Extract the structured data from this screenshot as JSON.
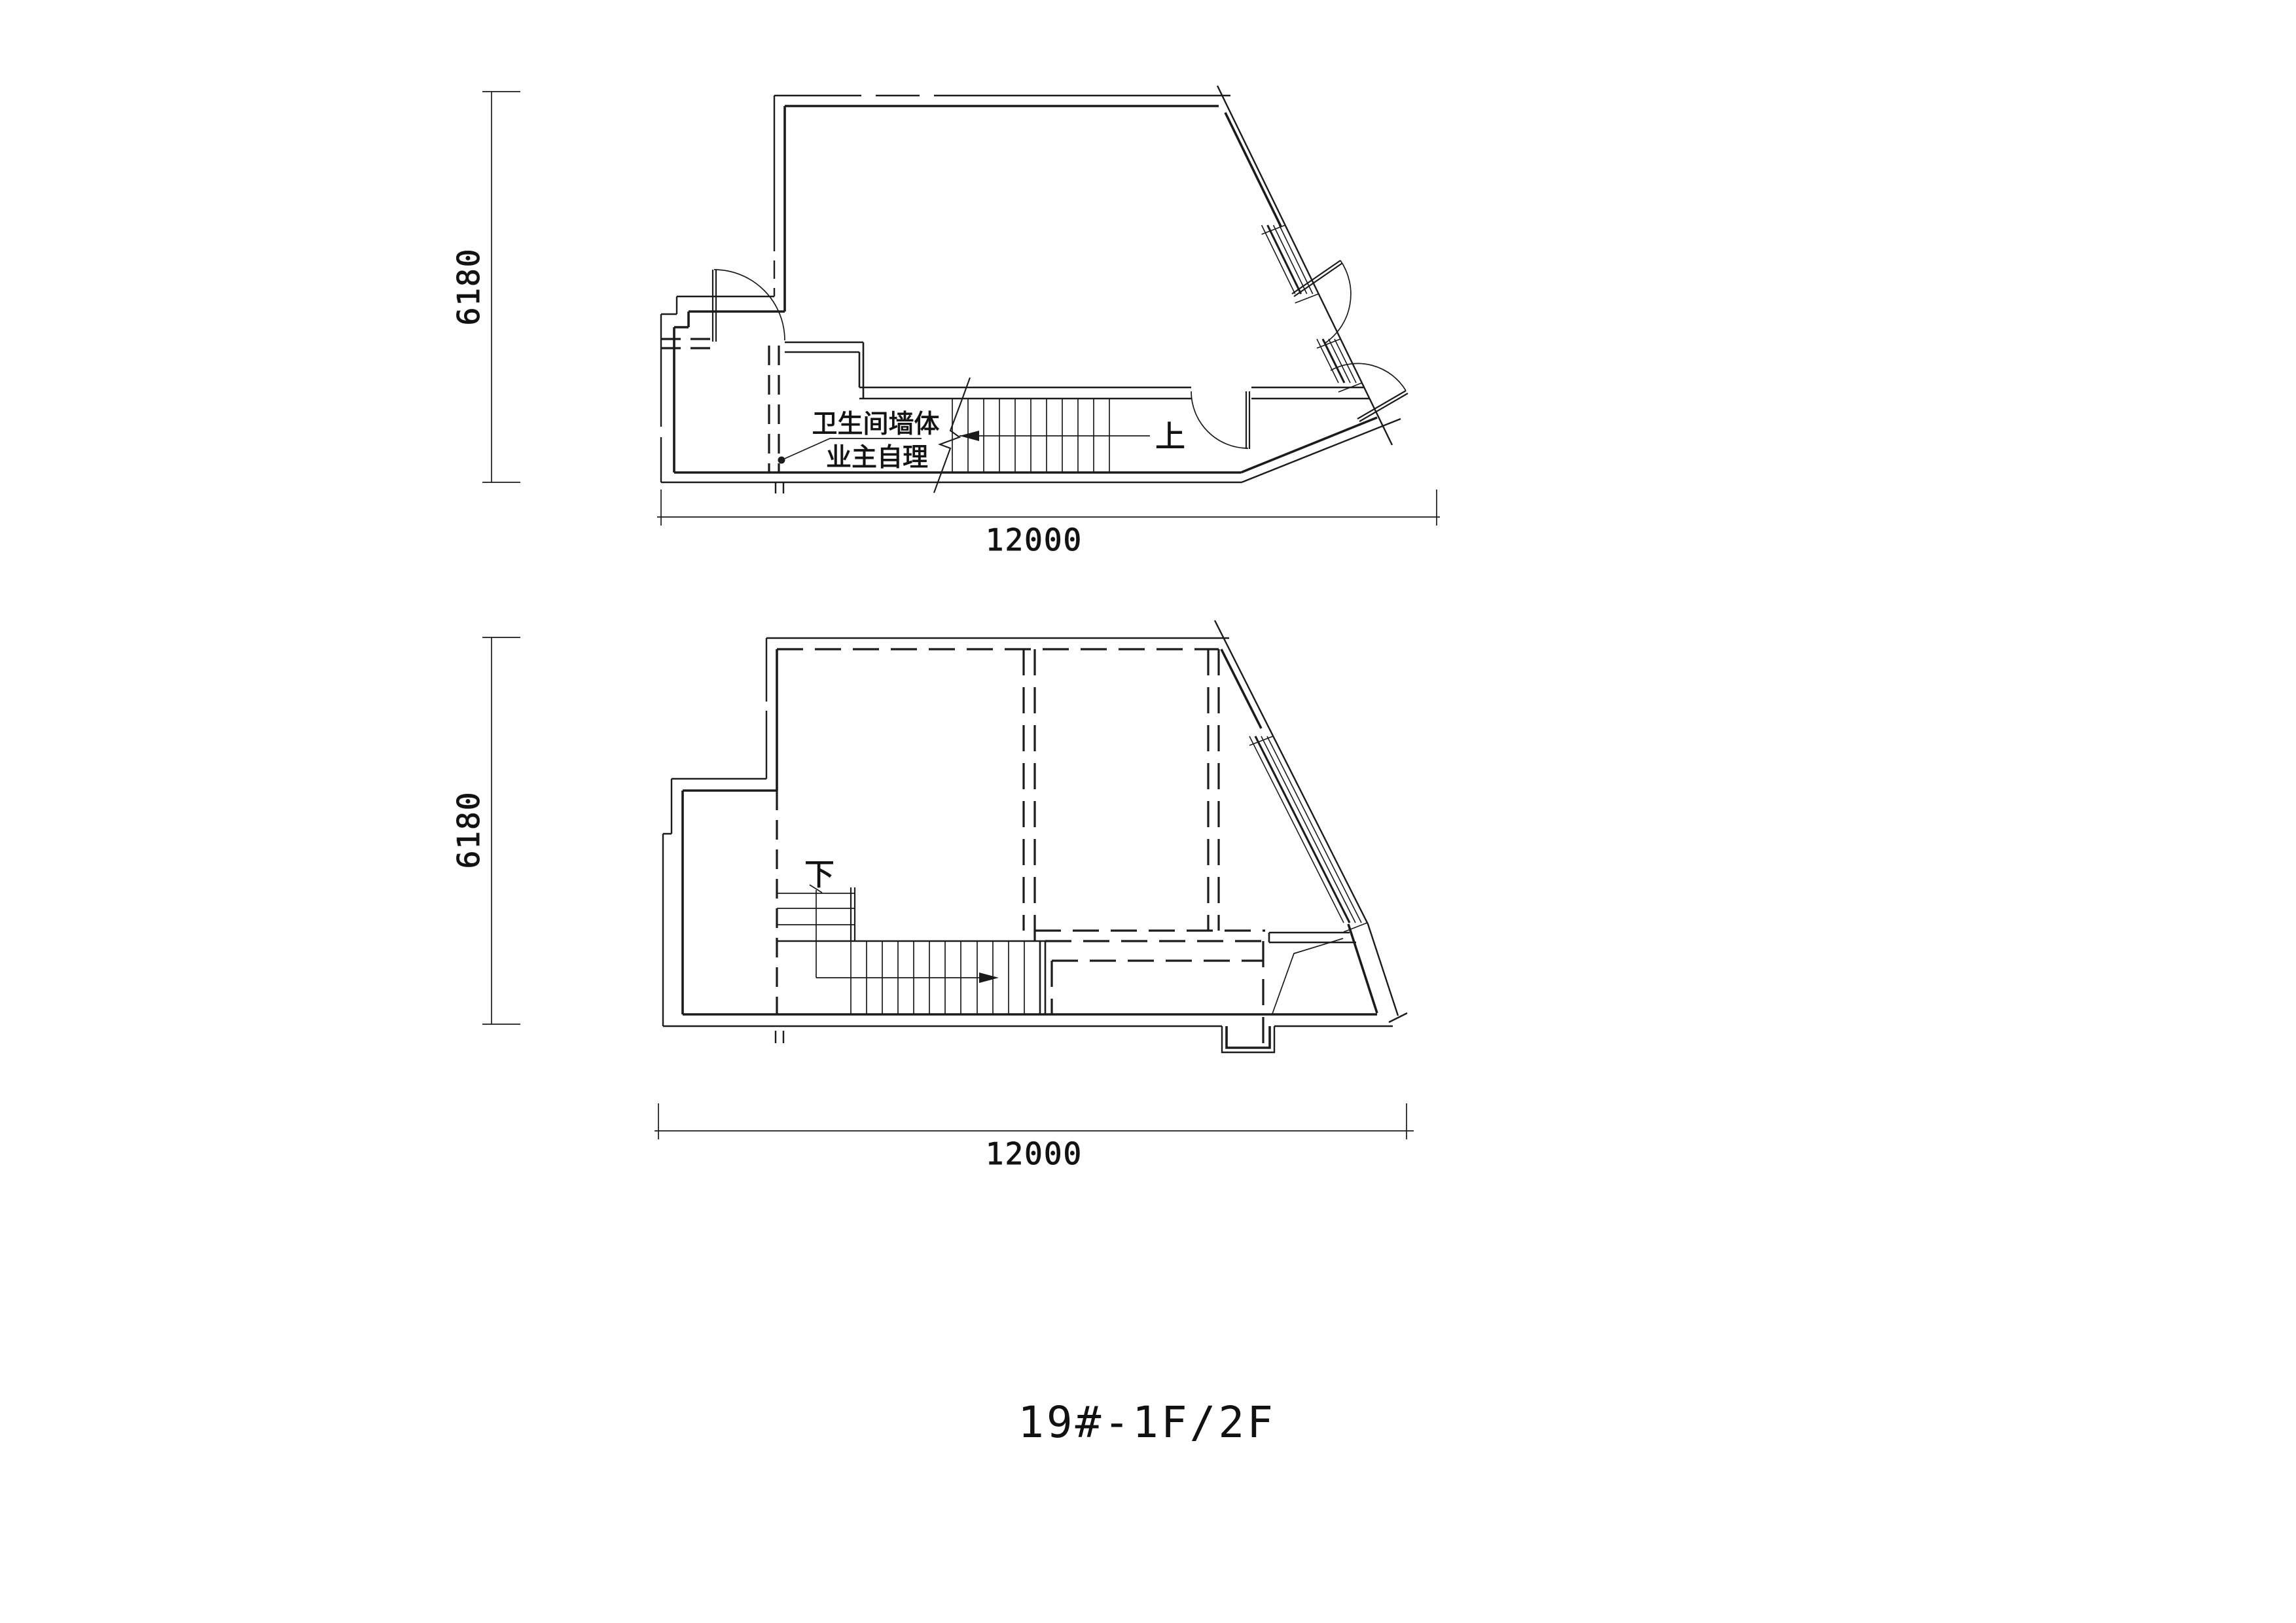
{
  "title": {
    "text": "19#-1F/2F"
  },
  "drawing": {
    "floor1": {
      "stair_direction_label": "上",
      "annotation_line1": "卫生间墙体",
      "annotation_line2": "业主自理",
      "dim_width": "12000",
      "dim_height": "6180"
    },
    "floor2": {
      "stair_direction_label": "下",
      "dim_width": "12000",
      "dim_height": "6180"
    }
  },
  "colors": {
    "line": "#1b1b1b",
    "background": "#ffffff"
  }
}
